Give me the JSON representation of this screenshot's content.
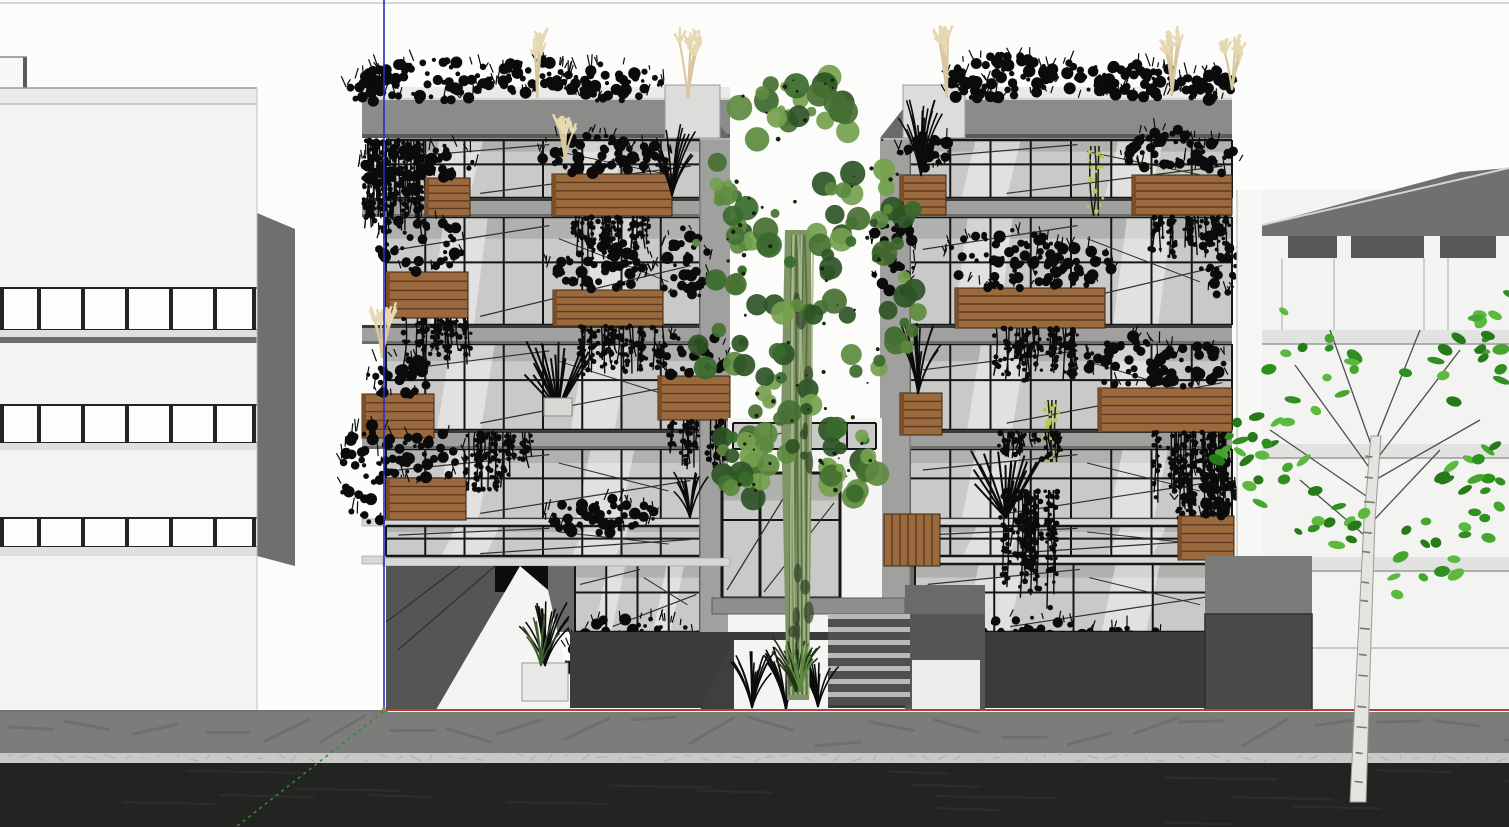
{
  "meta": {
    "app": "3d-modeling-viewport",
    "description": "SketchUp-style elevation render: planted apartment building between two white buildings, street in foreground",
    "canvas": {
      "width": 1509,
      "height": 827
    }
  },
  "colors": {
    "sky": "#fcfcfa",
    "skyline": "#c9c9c7",
    "bgWall": "#f3f3f1",
    "bgWallEdge": "#b9b9b7",
    "sideWall": "#6f6f6d",
    "parapet": "#eaeae8",
    "winFrame": "#242422",
    "winGlass": "#fdfdfc",
    "bandLight": "#dfdfdd",
    "bandDark": "#6e6e6c",
    "fascia": "#8b8b89",
    "fasciaTop": "#d4d4d2",
    "fasciaBottom": "#5a5a58",
    "parapetBlock": "#dcdcda",
    "returnWall": "#a0a09e",
    "returnWedge": "#6a6a68",
    "glass": "#c9c9c7",
    "glassShadow": "#b0b0ae",
    "glassLight": "#efefed",
    "mullion": "#161614",
    "reflect": "#ffffff",
    "diag": "#30302e",
    "slabFace": "#a0a09e",
    "slabTopShadow": "#3a3a38",
    "slabDrip": "#6e6e6c",
    "slabThin": "#d7d7d5",
    "wood": "#9a6a3e",
    "woodSlat": "#5e3a1c",
    "woodShade": "#7a4e28",
    "plant": "#0b0b0b",
    "plantGreenDark": "#3f5a2f",
    "pampas": "#d8c79e",
    "pampasHead": "#e6d8b2",
    "vineDot": "#b9c94a",
    "plaza": "#3b3b39",
    "plazaDark": "#2e2e2c",
    "platform": "#8f8f8d",
    "stepTread": "#b9b9b7",
    "stepRiser": "#4f4f4d",
    "stairWall": "#565654",
    "rampWall": "#555553",
    "whitePaving": "#f4f4f2",
    "whiteBox": "#e9e9e7",
    "treeGreens": [
      "#2f5426",
      "#477032",
      "#5d8a3f",
      "#74a14e",
      "#3a6a2d"
    ],
    "trunkBase": "#7f9566",
    "trunkLight": "#a9bd8d",
    "trunkDark": "#55693f",
    "birchTrunk": "#e4e4e0",
    "birchEdge": "#9a9a98",
    "birchMark": "#77776f",
    "branch": "#4e4e4c",
    "birchLeaves": [
      "#2f8f1f",
      "#46a52e",
      "#5cb93f",
      "#267a18"
    ],
    "sidewalk": "#7c7c7a",
    "sidewalkStreak": "#6f6f6d",
    "curb": "#c8c8c6",
    "curbSpeckle": "#aeaeac",
    "road": "#232321",
    "roadStreak": "#2c2c2a",
    "groundLine": "#4a4a48",
    "axisRed": "#c03a3a",
    "axisBlue": "#2a2ac8",
    "axisGreen": "#2f8f2f",
    "originDot": "#9a9a30"
  },
  "axes": {
    "origin": {
      "x": 384,
      "y": 710
    },
    "blue": {
      "x": 384,
      "y1": 0,
      "y2": 710
    },
    "red": {
      "x1": 388,
      "x2": 1509,
      "y": 710
    },
    "green": {
      "x1": 383,
      "y1": 712,
      "x2": 236,
      "y2": 827
    }
  },
  "street": {
    "ground_y": 710,
    "sidewalk": {
      "y": 712,
      "h": 41
    },
    "curb": {
      "y": 753,
      "h": 10
    },
    "road": {
      "y": 763,
      "h": 64
    }
  },
  "left_bg_building": {
    "facade": {
      "x": 0,
      "w": 257,
      "top": 104,
      "bottom": 710
    },
    "skyline_y": 3,
    "roof_box": {
      "x": 0,
      "y": 57,
      "w": 27,
      "h": 31
    },
    "parapet": {
      "y": 88,
      "h": 16
    },
    "side_wall": {
      "pts": [
        [
          257,
          213
        ],
        [
          295,
          229
        ],
        [
          295,
          566
        ],
        [
          257,
          556
        ]
      ]
    },
    "mullions_x": [
      0,
      37,
      81,
      125,
      169,
      213,
      252
    ],
    "rows": [
      {
        "y": 288,
        "h": 42,
        "band_light": [
          330,
          7
        ],
        "band_dark": [
          337,
          6
        ]
      },
      {
        "y": 405,
        "h": 38,
        "band_light": [
          443,
          7
        ],
        "band_dark": null
      },
      {
        "y": 518,
        "h": 29,
        "band_light": [
          547,
          9
        ],
        "band_dark": null
      }
    ]
  },
  "wings": {
    "floors": [
      {
        "y": 140,
        "h": 58
      },
      {
        "y": 217,
        "h": 108
      },
      {
        "y": 344,
        "h": 86
      },
      {
        "y": 449,
        "h": 70
      }
    ],
    "bands": [
      [
        198,
        19
      ],
      [
        325,
        19
      ],
      [
        430,
        19
      ]
    ],
    "thin_bands": [
      [
        519,
        7
      ],
      [
        556,
        8
      ]
    ],
    "clerestory": {
      "y": 526,
      "h": 30
    },
    "ground": {
      "y": 564,
      "h": 68
    },
    "plaza": {
      "y": 632,
      "h": 76
    },
    "roof": {
      "parapet_y": 87,
      "fascia_y": 100,
      "fascia_h": 38
    },
    "left": {
      "fascia_x": 362,
      "fascia_w": 368,
      "glass_x": 386,
      "glass_w": 314,
      "panels": 8,
      "return_x": 700,
      "return_w": 30,
      "return_side": "right",
      "parapet_block": {
        "x": 665,
        "y": 85,
        "w": 55,
        "h": 53
      },
      "ground_glass": {
        "x": 575,
        "w": 125
      },
      "plants": [
        [
          "bush",
          430,
          80,
          68,
          22,
          60
        ],
        [
          "bush",
          530,
          76,
          40,
          18,
          36
        ],
        [
          "bush",
          612,
          82,
          52,
          20,
          44
        ],
        [
          "bush",
          372,
          88,
          26,
          14,
          22
        ],
        [
          "pampas",
          537,
          98,
          55
        ],
        [
          "pampas",
          688,
          98,
          60
        ],
        [
          "hang",
          366,
          140,
          58,
          100,
          26
        ],
        [
          "bush",
          392,
          170,
          34,
          26,
          30
        ],
        [
          "box",
          425,
          178,
          45,
          38
        ],
        [
          "bush",
          448,
          162,
          28,
          18,
          24
        ],
        [
          "box",
          552,
          174,
          120,
          42
        ],
        [
          "bush",
          586,
          152,
          46,
          22,
          40
        ],
        [
          "bush",
          645,
          160,
          30,
          16,
          24
        ],
        [
          "pampas",
          565,
          160,
          34
        ],
        [
          "tuft",
          672,
          196,
          72,
          26,
          16
        ],
        [
          "hang",
          575,
          216,
          80,
          45,
          20
        ],
        [
          "box",
          386,
          272,
          82,
          46
        ],
        [
          "bush",
          420,
          244,
          44,
          30,
          40
        ],
        [
          "hang",
          400,
          318,
          70,
          60,
          18
        ],
        [
          "box",
          553,
          290,
          110,
          36
        ],
        [
          "bush",
          600,
          264,
          54,
          26,
          46
        ],
        [
          "hang",
          580,
          326,
          85,
          55,
          22
        ],
        [
          "bush",
          684,
          264,
          26,
          40,
          30
        ],
        [
          "box",
          362,
          394,
          72,
          44
        ],
        [
          "pampas",
          382,
          358,
          42
        ],
        [
          "bush",
          398,
          376,
          32,
          22,
          28
        ],
        [
          "box",
          658,
          376,
          72,
          44
        ],
        [
          "bush",
          692,
          356,
          36,
          24,
          30
        ],
        [
          "hang",
          672,
          420,
          55,
          50,
          16
        ],
        [
          "spiky",
          558,
          410,
          70,
          34
        ],
        [
          "whitebox",
          544,
          398,
          28,
          18
        ],
        [
          "hang",
          468,
          432,
          70,
          60,
          20
        ],
        [
          "bush",
          372,
          472,
          32,
          52,
          44
        ],
        [
          "box",
          386,
          478,
          80,
          42
        ],
        [
          "bush",
          422,
          458,
          44,
          28,
          36
        ],
        [
          "bush",
          600,
          516,
          56,
          18,
          40
        ],
        [
          "tuft",
          690,
          518,
          48,
          20,
          12
        ],
        [
          "bush",
          636,
          642,
          64,
          26,
          56
        ],
        [
          "bush",
          598,
          658,
          42,
          20,
          36
        ]
      ]
    },
    "right": {
      "fascia_x": 903,
      "fascia_w": 329,
      "glass_x": 910,
      "glass_w": 322,
      "panels": 8,
      "return_x": 880,
      "return_w": 30,
      "return_side": "left",
      "parapet_block": {
        "x": 903,
        "y": 85,
        "w": 62,
        "h": 53
      },
      "ground_glass": {
        "x": 915,
        "w": 317
      },
      "plants": [
        [
          "bush",
          1002,
          76,
          56,
          22,
          52
        ],
        [
          "bush",
          1082,
          80,
          46,
          20,
          40
        ],
        [
          "bush",
          1142,
          82,
          40,
          18,
          34
        ],
        [
          "bush",
          1208,
          86,
          30,
          16,
          26
        ],
        [
          "bush",
          968,
          88,
          24,
          13,
          20
        ],
        [
          "pampas",
          947,
          98,
          62
        ],
        [
          "pampas",
          1172,
          96,
          60
        ],
        [
          "pampas",
          1232,
          90,
          40
        ],
        [
          "box",
          900,
          175,
          46,
          40
        ],
        [
          "tuft",
          921,
          176,
          78,
          24,
          16
        ],
        [
          "bush",
          926,
          152,
          28,
          18,
          24
        ],
        [
          "box",
          1132,
          175,
          100,
          40
        ],
        [
          "bush",
          1162,
          150,
          42,
          22,
          38
        ],
        [
          "bush",
          1212,
          158,
          28,
          16,
          22
        ],
        [
          "vinedots",
          1095,
          146,
          70
        ],
        [
          "hang",
          1150,
          216,
          82,
          42,
          20
        ],
        [
          "bush",
          893,
          254,
          22,
          46,
          34
        ],
        [
          "box",
          955,
          288,
          150,
          40
        ],
        [
          "bush",
          1005,
          260,
          62,
          30,
          56
        ],
        [
          "bush",
          1072,
          266,
          42,
          22,
          36
        ],
        [
          "hang",
          985,
          328,
          90,
          55,
          24
        ],
        [
          "bush",
          1220,
          264,
          20,
          36,
          26
        ],
        [
          "box",
          900,
          393,
          42,
          42
        ],
        [
          "tuft",
          918,
          394,
          72,
          24,
          15
        ],
        [
          "box",
          1098,
          388,
          134,
          44
        ],
        [
          "bush",
          1132,
          362,
          46,
          26,
          40
        ],
        [
          "bush",
          1192,
          366,
          40,
          22,
          34
        ],
        [
          "vinedots",
          1052,
          400,
          62
        ],
        [
          "hang",
          1000,
          432,
          66,
          30,
          18
        ],
        [
          "hang",
          1155,
          432,
          95,
          100,
          26
        ],
        [
          "spiky",
          1006,
          518,
          68,
          36
        ],
        [
          "hang",
          1000,
          490,
          55,
          120,
          18
        ],
        [
          "box",
          1178,
          516,
          56,
          44
        ],
        [
          "bush",
          1206,
          496,
          32,
          24,
          28
        ],
        [
          "screen",
          884,
          514,
          56,
          52
        ],
        [
          "bush",
          1004,
          640,
          92,
          26,
          70
        ],
        [
          "bush",
          1134,
          648,
          52,
          22,
          40
        ],
        [
          "bush",
          944,
          652,
          36,
          18,
          28
        ]
      ]
    }
  },
  "entrance": {
    "bay": {
      "x": 728,
      "w": 154,
      "top": 418,
      "bottom": 648
    },
    "transom": {
      "x": 733,
      "y": 423,
      "w": 143,
      "h": 26,
      "mullions": [
        733,
        771,
        809,
        847,
        876
      ]
    },
    "door": {
      "x": 722,
      "y": 473,
      "w": 118,
      "h": 125,
      "mullions": [
        722,
        760,
        798,
        840
      ],
      "midrail_y": 520
    },
    "platform": {
      "x": 712,
      "y": 598,
      "w": 193,
      "h": 16
    },
    "stairs": {
      "x": 828,
      "w": 82,
      "top": 614,
      "steps": 7,
      "step_h": 13
    },
    "left_wedge": [
      [
        700,
        710
      ],
      [
        734,
        640
      ],
      [
        734,
        710
      ]
    ],
    "right_wall": {
      "x": 905,
      "y": 614,
      "w": 80,
      "h": 96
    },
    "upper_landing": {
      "x": 905,
      "y": 585,
      "w": 80,
      "h": 29
    },
    "white_bed": {
      "x": 734,
      "y": 640,
      "w": 94,
      "h": 70
    },
    "white_path": {
      "x": 912,
      "y": 660,
      "w": 68,
      "h": 50
    },
    "tufts": [
      [
        752,
        708,
        58
      ],
      [
        786,
        710,
        64
      ],
      [
        818,
        707,
        56
      ]
    ],
    "green_tuft": [
      798,
      700,
      52
    ]
  },
  "left_wing_ground": {
    "band": {
      "x": 383,
      "y": 558,
      "w": 347,
      "h": 8
    },
    "ramp": [
      [
        386,
        566
      ],
      [
        520,
        566
      ],
      [
        436,
        710
      ],
      [
        386,
        710
      ]
    ],
    "ramp_rails": [
      [
        [
          495,
          566
        ],
        [
          398,
          650
        ]
      ],
      [
        [
          460,
          566
        ],
        [
          386,
          622
        ]
      ]
    ],
    "black_box": {
      "x": 495,
      "y": 566,
      "w": 53,
      "h": 26
    },
    "white_wedge": [
      [
        436,
        710
      ],
      [
        520,
        566
      ],
      [
        548,
        590
      ],
      [
        575,
        710
      ]
    ],
    "white_planter": {
      "x": 522,
      "y": 663,
      "w": 46,
      "h": 38
    },
    "planter_plant": [
      545,
      666,
      66
    ]
  },
  "right_bg_building": {
    "end_wall": {
      "x": 1237,
      "w": 25,
      "top": 190
    },
    "roof_poly": [
      [
        1262,
        236
      ],
      [
        1262,
        225
      ],
      [
        1460,
        172
      ],
      [
        1509,
        168
      ],
      [
        1509,
        236
      ]
    ],
    "clerestory": {
      "y": 236,
      "h": 22,
      "piers": [
        [
          1262,
          26
        ],
        [
          1337,
          14
        ],
        [
          1424,
          16
        ],
        [
          1496,
          13
        ]
      ]
    },
    "bands_y": [
      330,
      444,
      557
    ],
    "joints_x": [
      1282,
      1334,
      1424,
      1448
    ],
    "low_line": {
      "y": 648,
      "x1": 1312,
      "x2": 1509
    },
    "mid_wall": {
      "x": 1205,
      "y": 556,
      "w": 107,
      "h": 58
    },
    "dark_box": {
      "x": 1205,
      "y": 614,
      "w": 107,
      "h": 96
    }
  },
  "center_tree": {
    "trunk": [
      [
        787,
        700
      ],
      [
        781,
        420
      ],
      [
        785,
        230
      ],
      [
        811,
        230
      ],
      [
        812,
        430
      ],
      [
        809,
        700
      ]
    ],
    "canopy_ellipses": [
      [
        800,
        190,
        100,
        115
      ],
      [
        755,
        320,
        72,
        85
      ],
      [
        855,
        310,
        64,
        80
      ],
      [
        795,
        420,
        58,
        62
      ],
      [
        805,
        100,
        45,
        28
      ],
      [
        735,
        240,
        40,
        50
      ],
      [
        870,
        220,
        45,
        55
      ],
      [
        742,
        465,
        34,
        36
      ],
      [
        852,
        462,
        34,
        36
      ]
    ],
    "blob_count": 175,
    "base_tuft": [
      796,
      692,
      56
    ]
  },
  "birch_tree": {
    "trunk_left": [
      [
        1350,
        802
      ],
      [
        1358,
        640
      ],
      [
        1364,
        520
      ],
      [
        1371,
        436
      ]
    ],
    "trunk_right": [
      [
        1366,
        802
      ],
      [
        1371,
        640
      ],
      [
        1375,
        520
      ],
      [
        1381,
        436
      ]
    ],
    "branches": [
      [
        1371,
        470,
        1295,
        365
      ],
      [
        1373,
        450,
        1330,
        330
      ],
      [
        1374,
        445,
        1420,
        330
      ],
      [
        1376,
        460,
        1460,
        350
      ],
      [
        1372,
        500,
        1270,
        430
      ],
      [
        1370,
        540,
        1300,
        480
      ],
      [
        1374,
        520,
        1440,
        450
      ],
      [
        1375,
        480,
        1480,
        420
      ]
    ],
    "leaf_clusters": [
      [
        1285,
        390,
        60,
        85
      ],
      [
        1255,
        460,
        40,
        45
      ],
      [
        1355,
        350,
        55,
        60
      ],
      [
        1455,
        390,
        60,
        80
      ],
      [
        1470,
        500,
        45,
        70
      ],
      [
        1420,
        560,
        40,
        45
      ],
      [
        1330,
        520,
        35,
        40
      ],
      [
        1500,
        330,
        30,
        40
      ]
    ],
    "leaf_count": 96
  }
}
